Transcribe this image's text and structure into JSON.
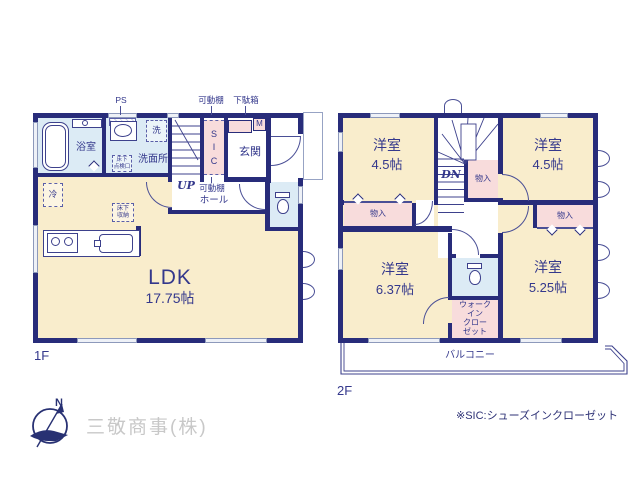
{
  "colors": {
    "wall": "#282c7a",
    "ink": "#34388c",
    "cream": "#f9edcc",
    "wet_blue": "#dcebf5",
    "closet_pink": "#f8dcdc",
    "company_gray": "#c8c8c8"
  },
  "floor1": {
    "label": "1F",
    "ldk_name": "LDK",
    "ldk_size": "17.75帖",
    "bath": "浴室",
    "washroom": "洗面所",
    "laundry": "洗",
    "genkan": "玄関",
    "sic": "S\nI\nC",
    "ps": "PS",
    "shelf_top": "可動棚",
    "shoe_box": "下駄箱",
    "meter": "M",
    "up": "UP",
    "shelf_hall": "可動棚",
    "hall": "ホール",
    "fridge": "冷",
    "floor_hatch": "床下\n点検口",
    "floor_storage": "床下\n収納"
  },
  "floor2": {
    "label": "2F",
    "room_tl_name": "洋室",
    "room_tl_size": "4.5帖",
    "room_tr_name": "洋室",
    "room_tr_size": "4.5帖",
    "room_bl_name": "洋室",
    "room_bl_size": "6.37帖",
    "room_br_name": "洋室",
    "room_br_size": "5.25帖",
    "dn": "DN",
    "closet": "物入",
    "wic": "ウォーク\nイン\nクロー\nゼット",
    "balcony": "バルコニー"
  },
  "footer": {
    "compass_n": "N",
    "company": "三敬商事(株)",
    "note": "※SIC:シューズインクローゼット"
  }
}
